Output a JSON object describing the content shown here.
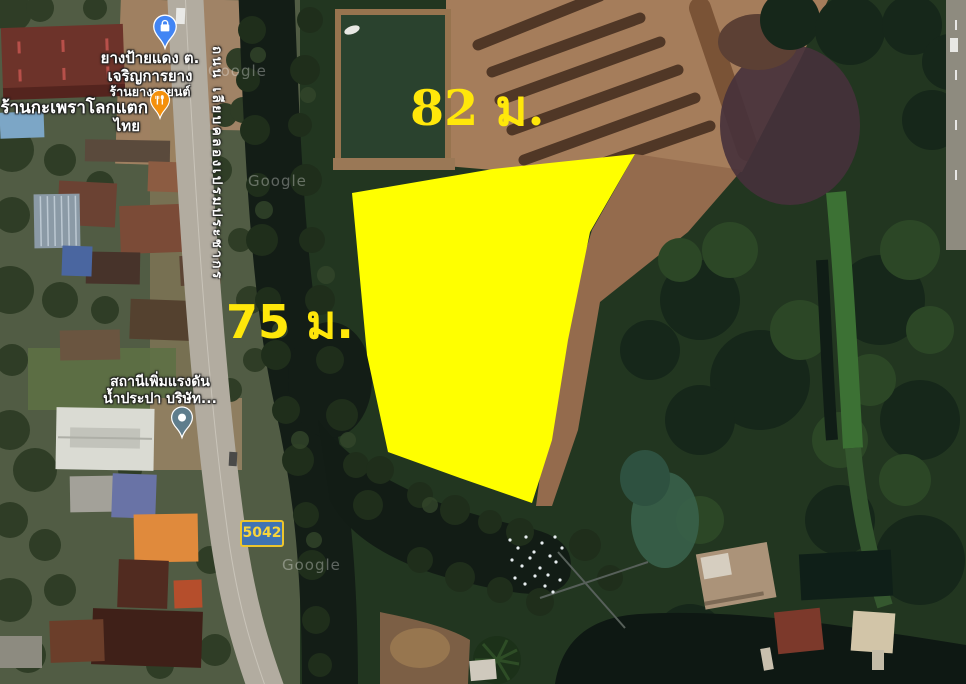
{
  "map": {
    "provider_watermark": "Google",
    "parcel": {
      "fill_color": "#FFFF00",
      "top_measurement": "82 ม.",
      "left_measurement": "75 ม."
    },
    "road": {
      "badge": "5042",
      "name": "ถนน เลียบคลองเปรมประชากร",
      "badge_bg": "#3F73B3",
      "badge_border": "#ECC52E",
      "badge_text_color": "#F7D43C"
    },
    "pois": [
      {
        "line1": "ยางป้ายแดง ต.",
        "line2": "เจริญการยาง",
        "subtitle": "ร้านยางรถยนต์",
        "icon": "shopping-pin",
        "pin_color": "#4285F4"
      },
      {
        "line1": "ร้านกะเพราโลกแตก",
        "line2": "ไทย",
        "icon": "restaurant-pin",
        "pin_color": "#F4900C"
      },
      {
        "line1": "สถานีเพิ่มแรงดัน",
        "line2": "น้ำประปา บริษัท...",
        "icon": "place-pin",
        "pin_color": "#5F7D8C"
      }
    ]
  }
}
